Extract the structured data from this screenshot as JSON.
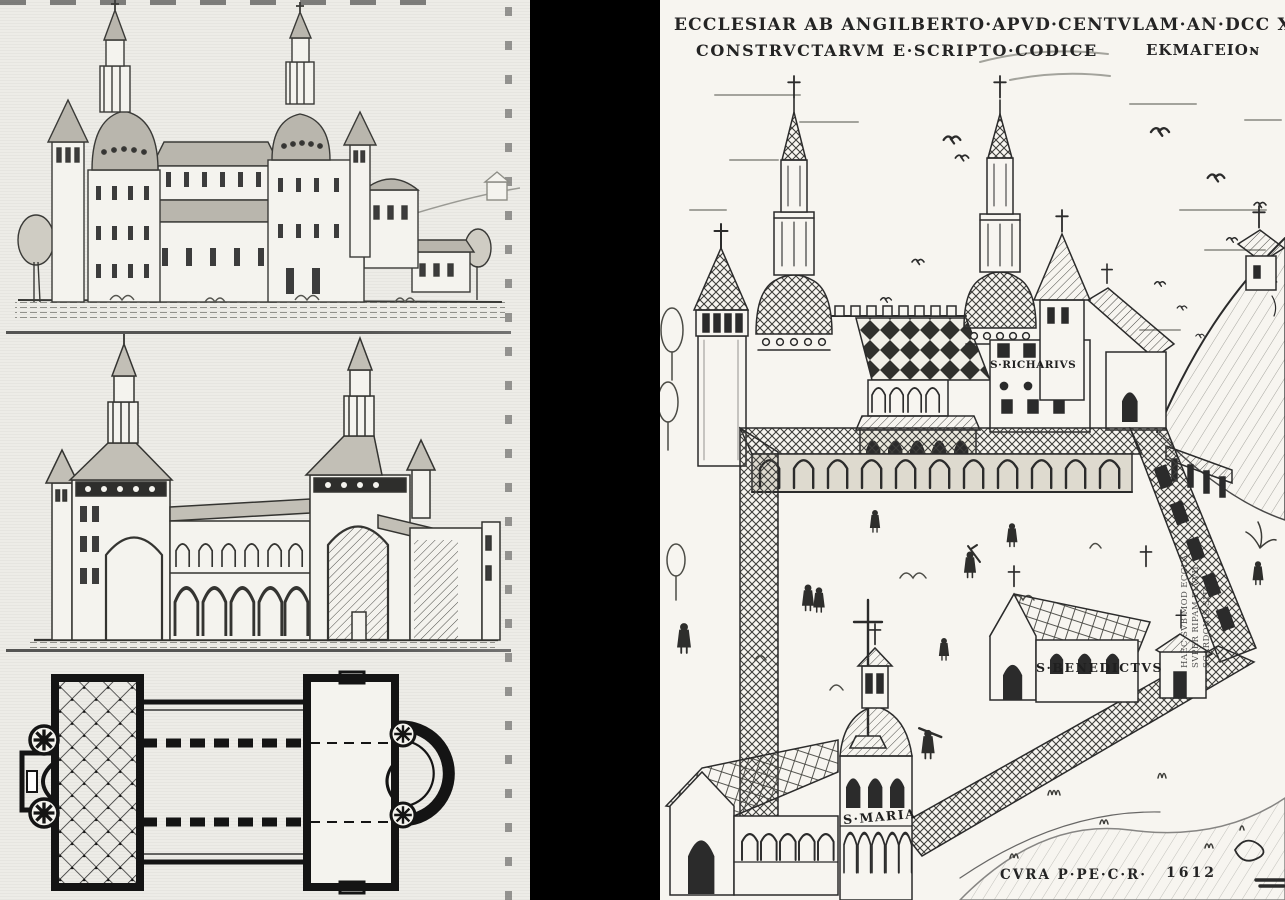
{
  "artwork": {
    "left_page": {
      "figure_names": [
        "perspective-view-of-abbey-church",
        "longitudinal-section",
        "ground-plan"
      ]
    },
    "right_page": {
      "title_line1": "ECCLESIAR AB ANGILBERTO·APVD·CENTVLAM·AN·DCC XCIX",
      "title_line2": "CONSTRVCTARVM  E·SCRIPTO·CODICE",
      "title_line2_right": "EKMAΓEIOɴ",
      "labels": {
        "richarius": "S·RICHARIVS",
        "benedictus": "S·BENEDICTVS",
        "maria": "S·MARIA"
      },
      "side_note_lines": [
        "HAEC SVB MOD ECCLA·",
        "SVPER RIPAM FLVVII",
        "SCARDONIS SITA"
      ],
      "credit": "CVRA P·PE·C·R·",
      "year": "1612"
    },
    "colors": {
      "ink": "#2b2b2b",
      "paper_left": "#edece7",
      "paper_right": "#f7f5f0",
      "divider": "#000000",
      "roof_gray": "#b9b6ad"
    }
  }
}
